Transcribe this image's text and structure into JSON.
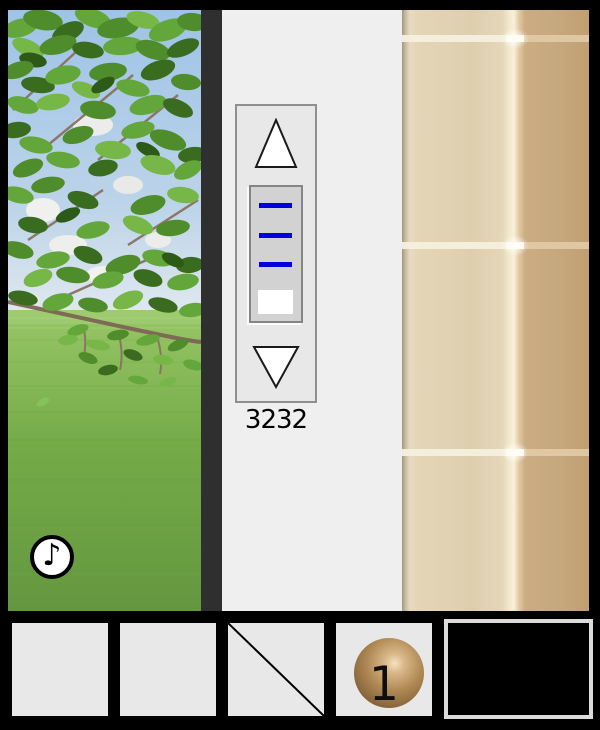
{
  "counter": {
    "value": "3232"
  },
  "lever": {
    "mark_count": 3,
    "handle_position": "bottom"
  },
  "inventory": {
    "ball_item": {
      "count_label": "1"
    },
    "empty_slots": 2,
    "crossed_slot": true
  },
  "audio_toggle": {
    "glyph": "♪"
  },
  "colors": {
    "accent_blue": "#0000e0",
    "panel_gray": "#efefef",
    "frame_dark": "#2f2f2f",
    "wall_tile_light": "#e2d3b4",
    "wall_tile_dark": "#c6a77e",
    "grout_cream": "#f6eed8",
    "slot_gray": "#e8e8e8",
    "ball_gold": "#b9935f",
    "grass_green": "#6ba23f",
    "foliage_green": "#57962f",
    "sky_blue": "#a9c9ea"
  }
}
